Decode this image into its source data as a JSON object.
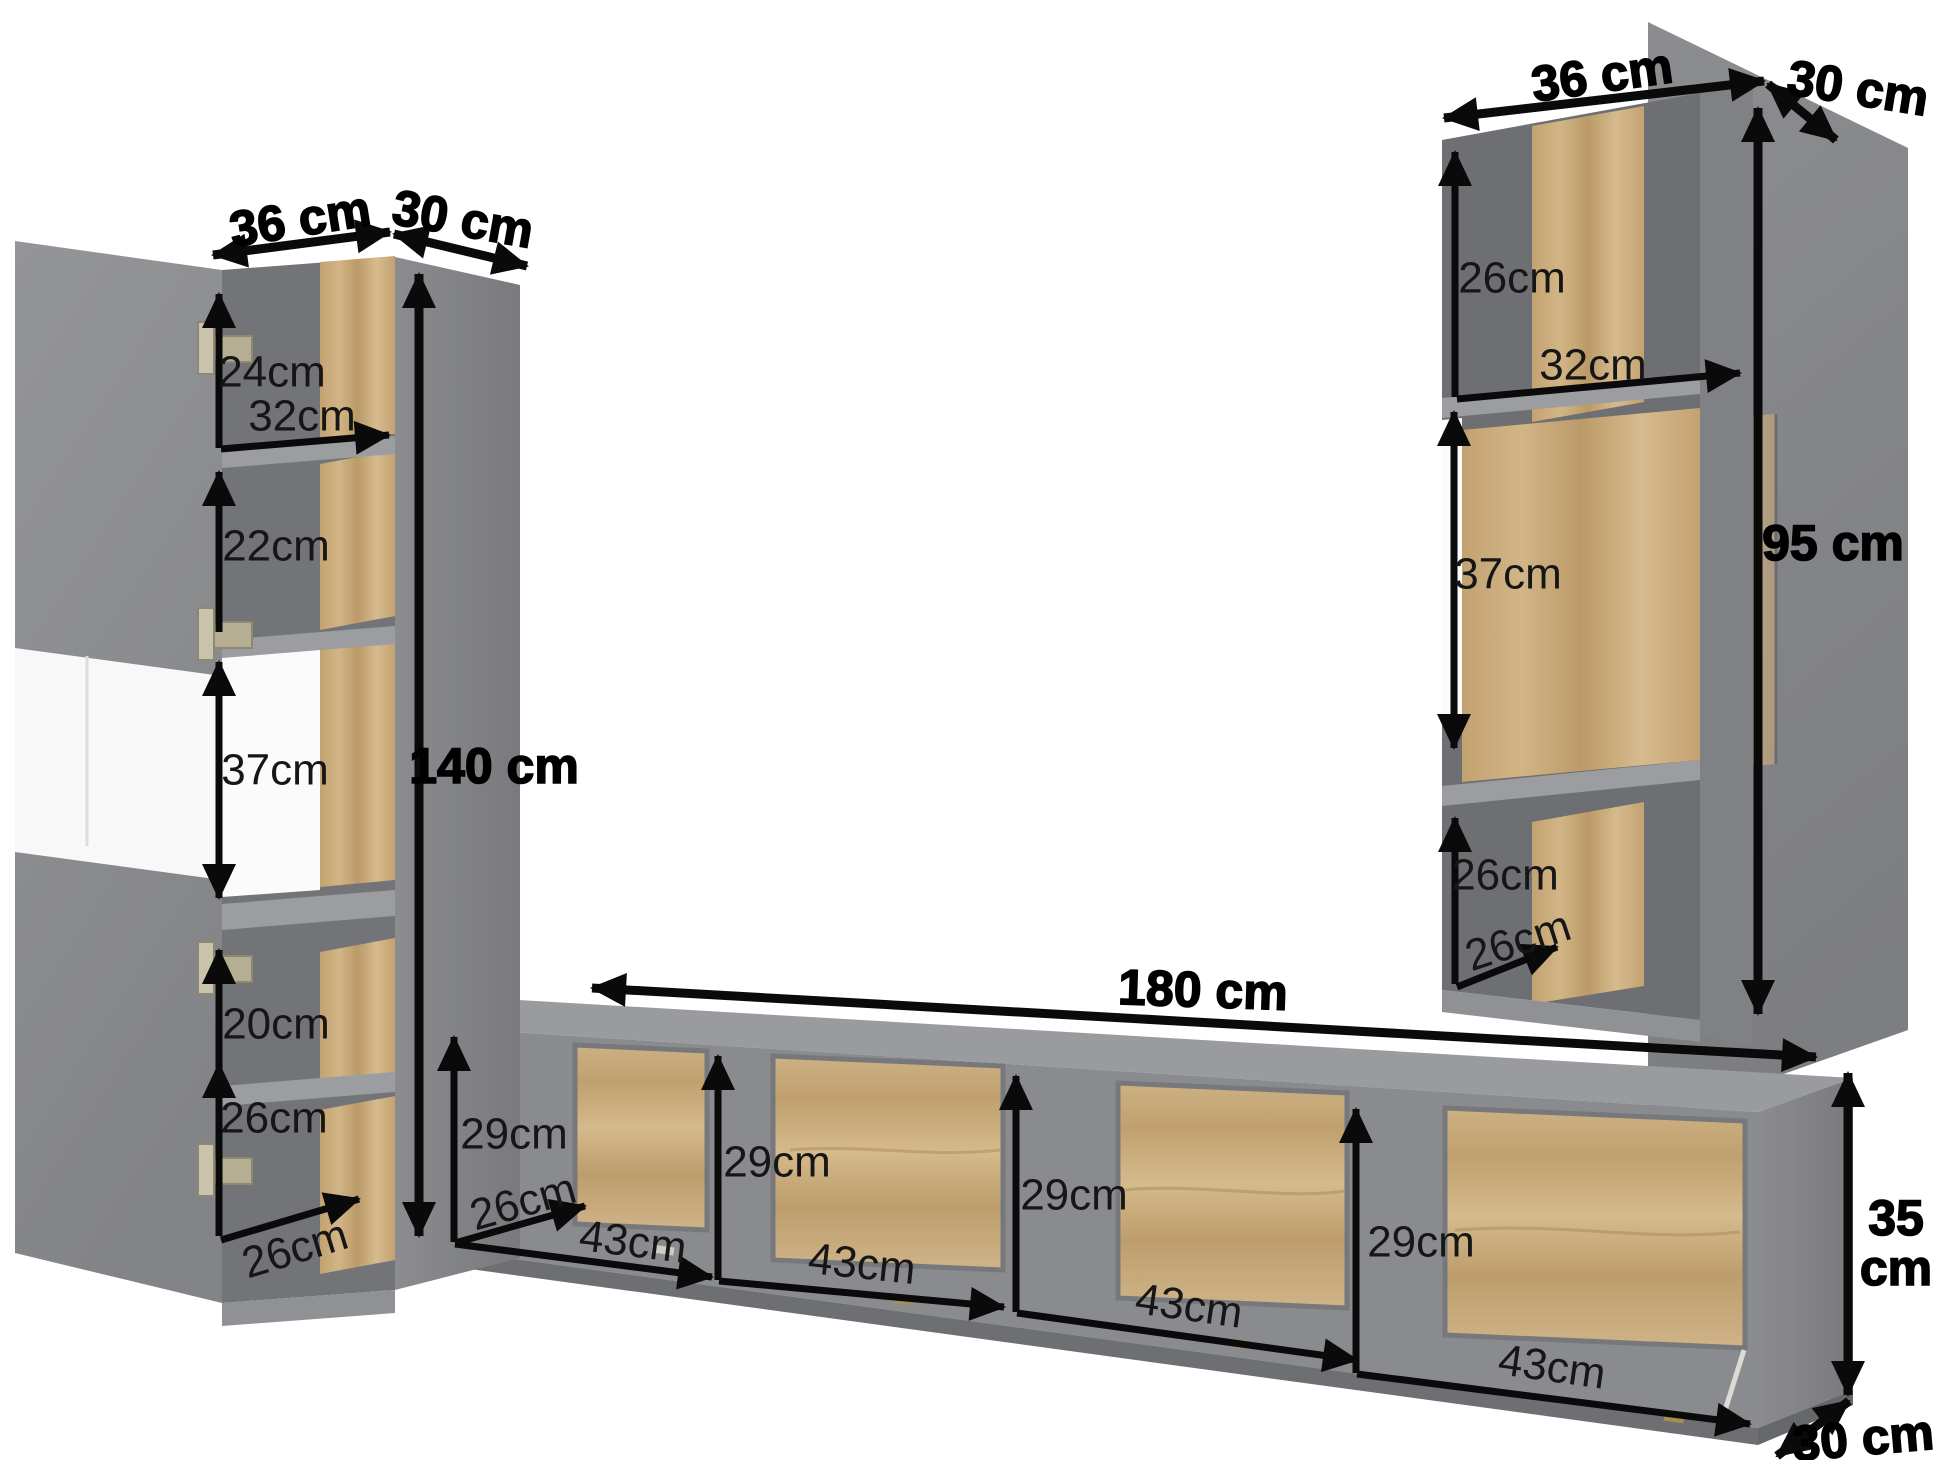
{
  "diagram": {
    "description": "furniture wall-unit dimension diagram",
    "left_cabinet": {
      "width": "36 cm",
      "depth": "30 cm",
      "height": "140 cm",
      "sections": [
        "24cm",
        "22cm",
        "37cm",
        "20cm",
        "26cm"
      ],
      "shelf_width": "32cm",
      "interior_depth": "26cm"
    },
    "right_cabinet": {
      "width": "36 cm",
      "depth": "30 cm",
      "height": "95 cm",
      "sections": [
        "26cm",
        "37cm",
        "26cm"
      ],
      "shelf_width": "32cm",
      "interior_depth": "26cm"
    },
    "tv_stand": {
      "width": "180 cm",
      "height_value": "35",
      "height_unit": "cm",
      "depth": "30 cm",
      "interior_depth": "26cm",
      "compartment_heights": [
        "29cm",
        "29cm",
        "29cm",
        "29cm"
      ],
      "compartment_widths": [
        "43cm",
        "43cm",
        "43cm",
        "43cm"
      ]
    },
    "colors": {
      "background": "#ffffff",
      "cabinet_gray": "#8a8b8e",
      "interior_gray": "#737477",
      "wood": "#c9ac7c",
      "arrow": "#0a0a0a"
    }
  }
}
